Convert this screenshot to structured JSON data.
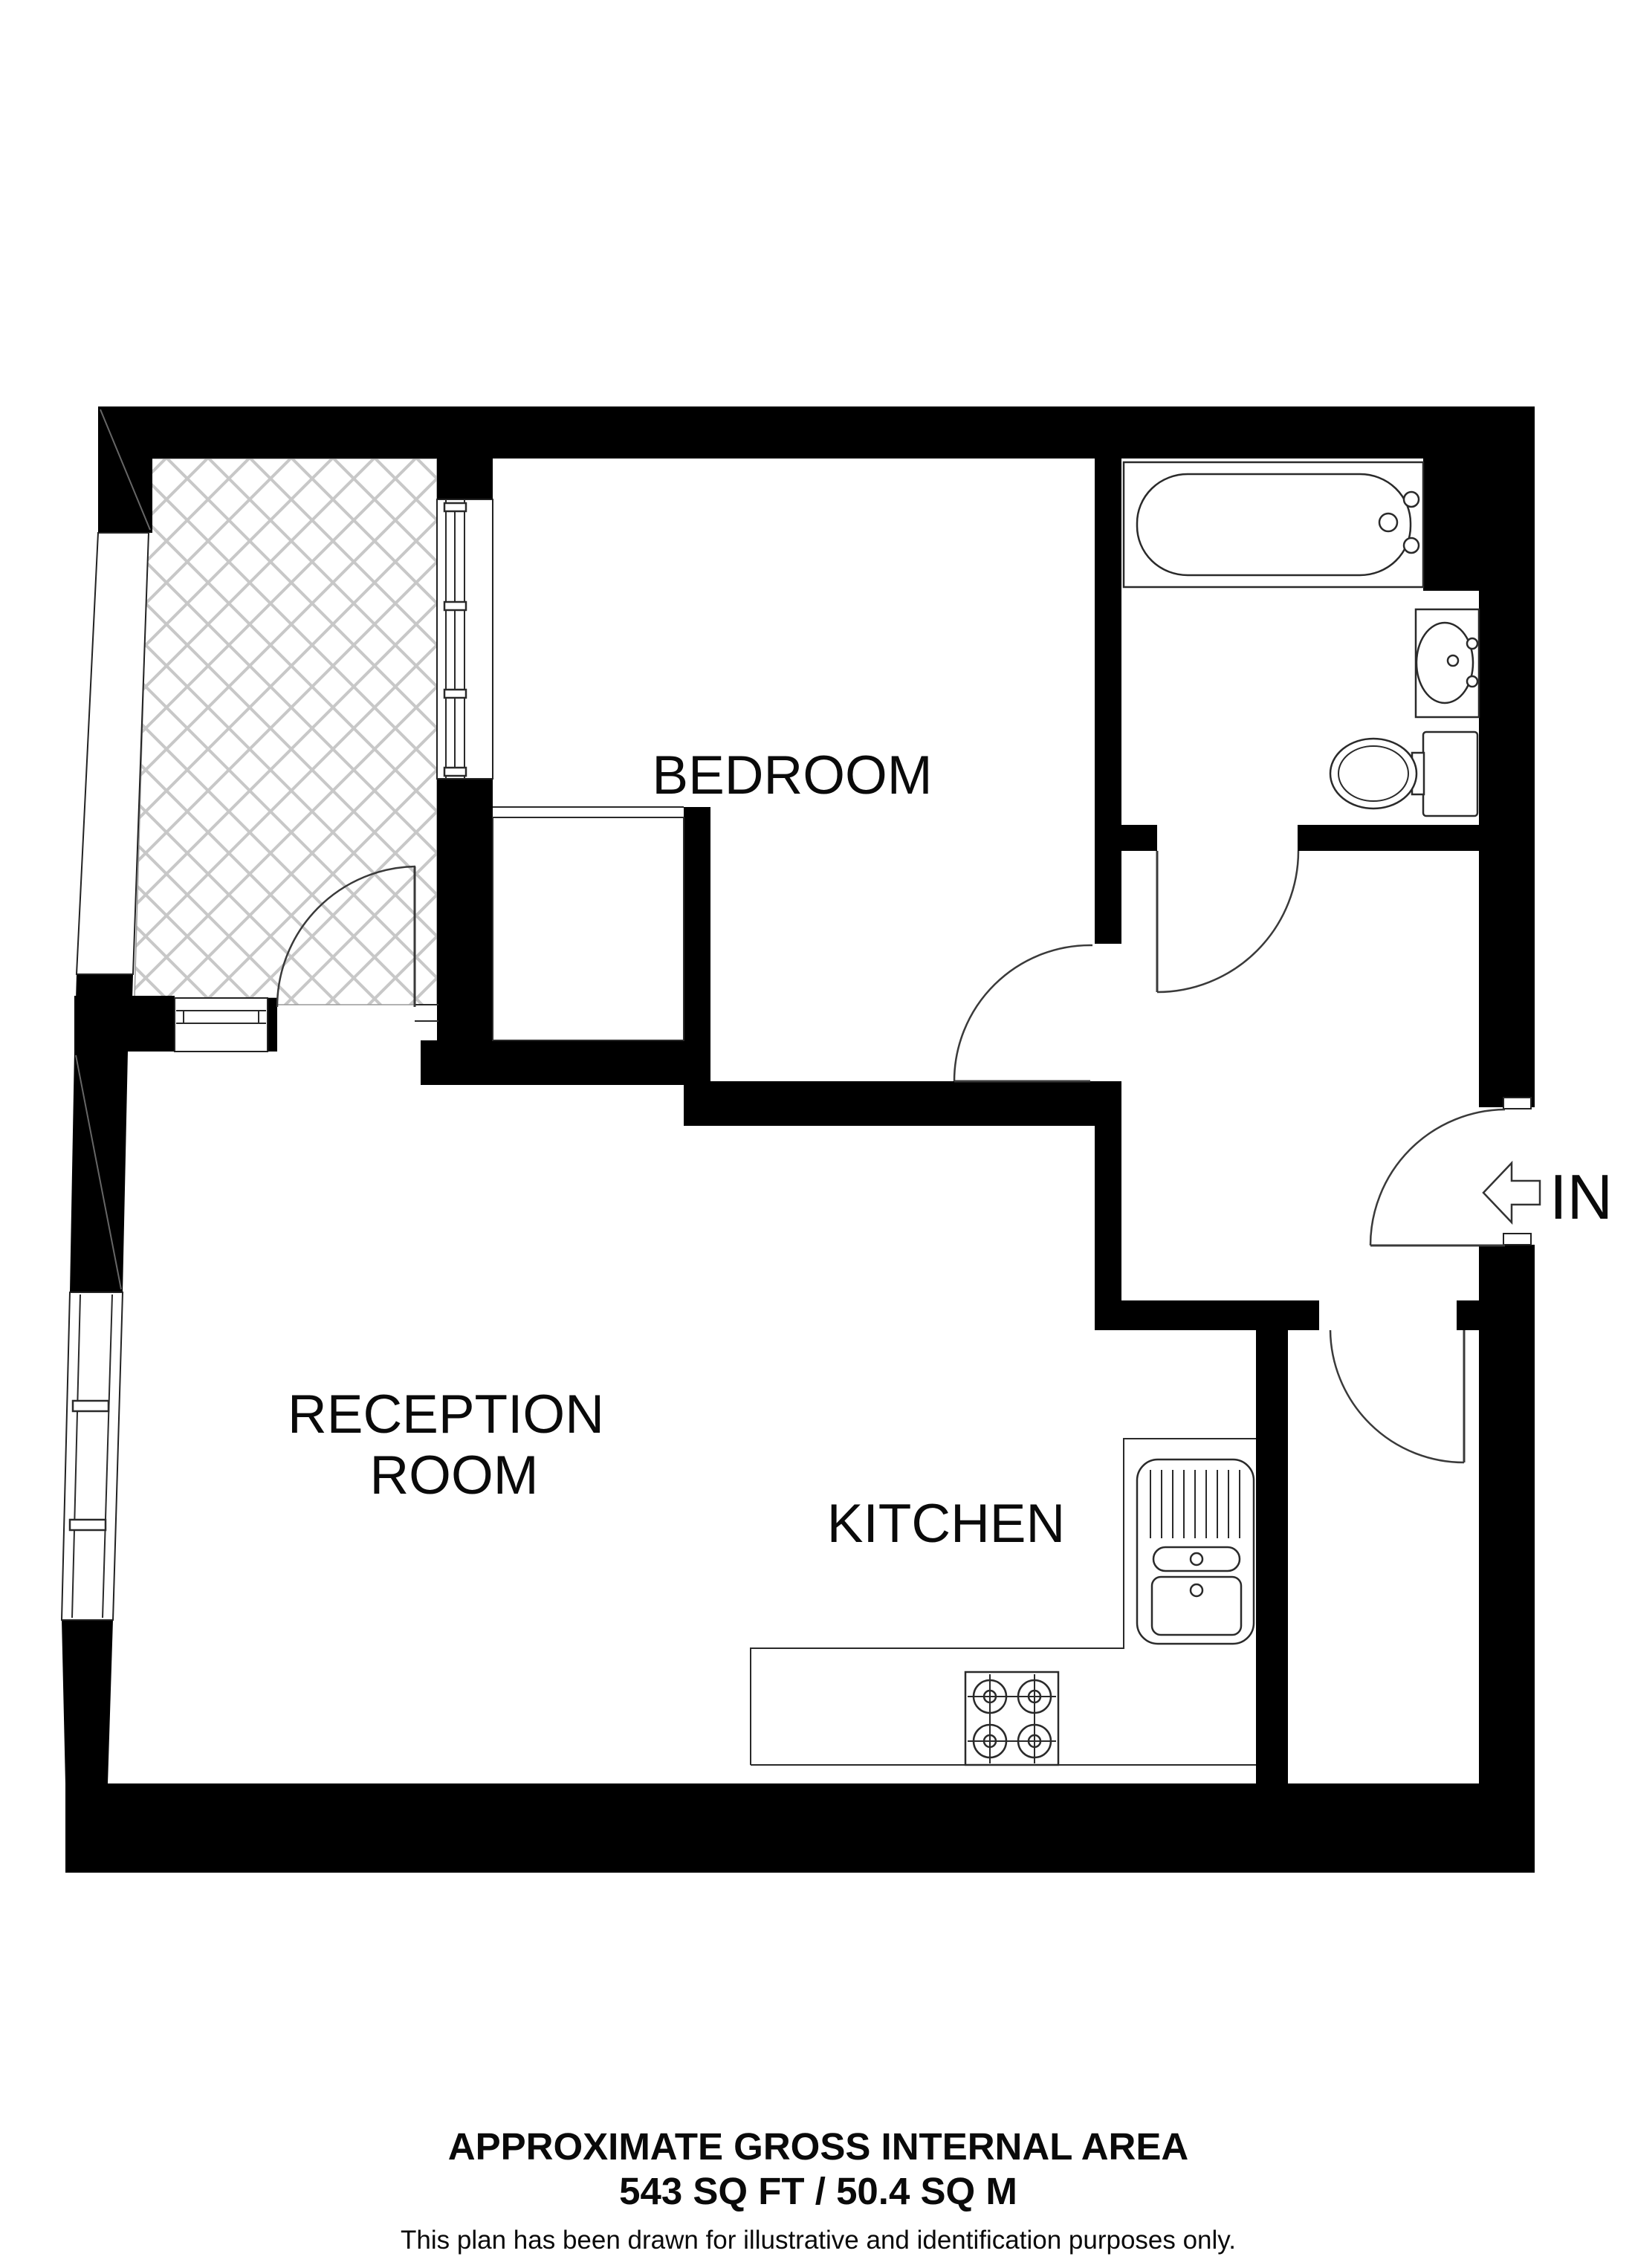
{
  "plan": {
    "rooms": {
      "bedroom": {
        "label": "BEDROOM"
      },
      "reception": {
        "label_line1": "RECEPTION",
        "label_line2": "ROOM"
      },
      "kitchen": {
        "label": "KITCHEN"
      }
    },
    "entrance": {
      "label": "IN",
      "icon": "arrow-left-icon"
    },
    "features": [
      "balcony-hatched-area",
      "bathtub",
      "wash-basin",
      "toilet",
      "closet",
      "kitchen-counter",
      "hob",
      "kitchen-sink",
      "windows",
      "door-swings"
    ],
    "colors": {
      "wall": "#000000",
      "hatch": "#c8c8c8",
      "background": "#ffffff",
      "outline": "#2a2a2a"
    }
  },
  "footer": {
    "line1": "APPROXIMATE GROSS INTERNAL AREA",
    "line2": "543 SQ FT / 50.4 SQ M",
    "area_sqft": "543 SQ FT",
    "area_sqm": "50.4 SQ M",
    "disclaimer": "This plan has been drawn for illustrative and identification purposes only."
  }
}
